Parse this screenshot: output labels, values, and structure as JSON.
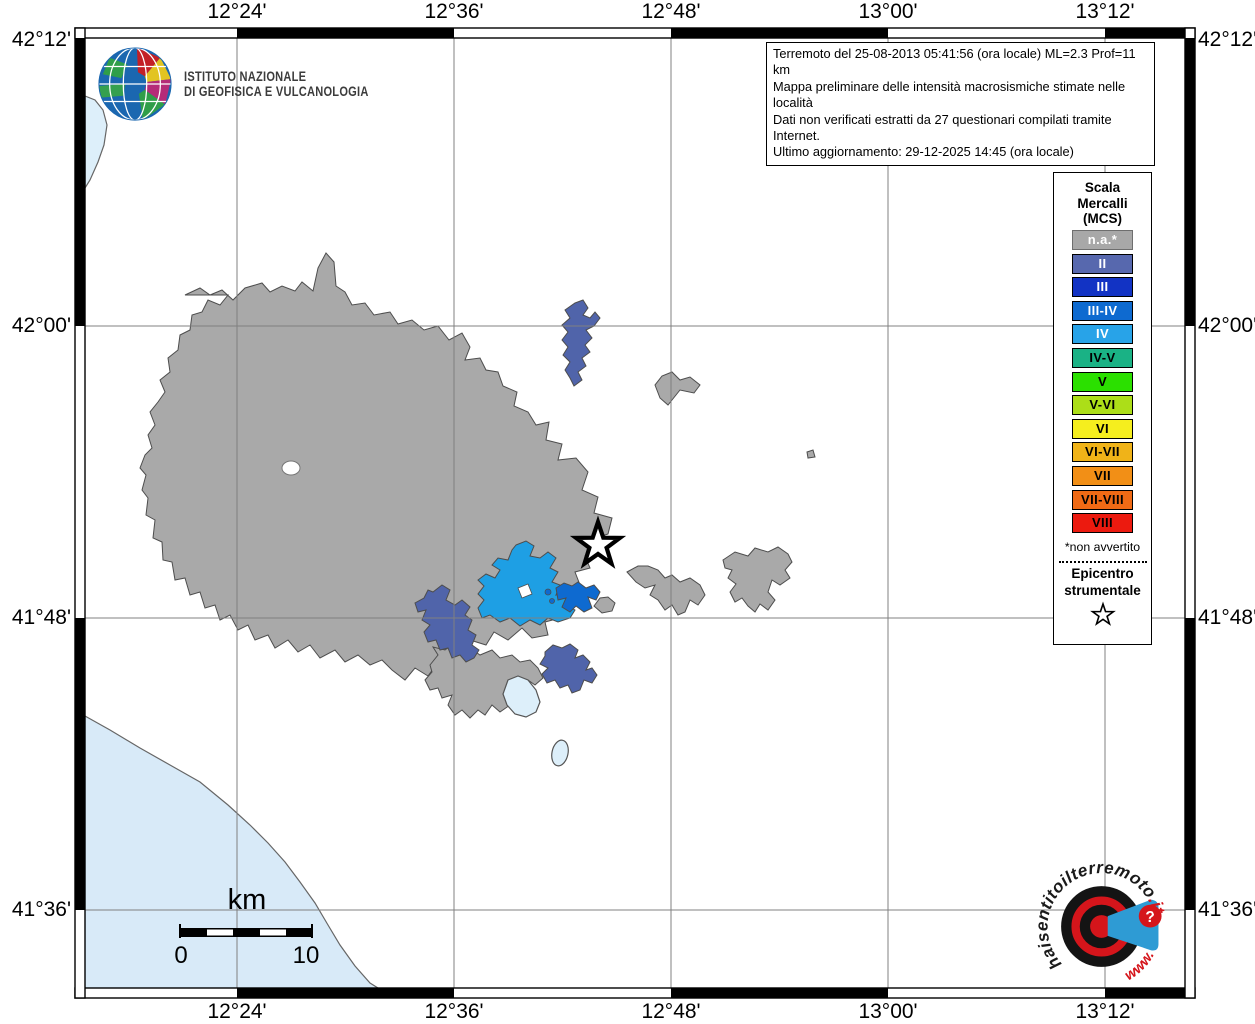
{
  "colors": {
    "muni_gray": "#a9a9a9",
    "muni_outline": "#4d4d4d",
    "sea": "#d8eaf8",
    "lake": "#ddeffa",
    "grid": "#808080",
    "intensity_ii": "#5064aa",
    "intensity_iii_iv": "#0e6ad0",
    "intensity_iv": "#1e9fe4",
    "frame": "#000000",
    "wm_red": "#d5151b",
    "wm_blue": "#2e9bd4"
  },
  "title_box": {
    "line1": "Terremoto del 25-08-2013 05:41:56 (ora locale) ML=2.3 Prof=11 km",
    "line2": "Mappa preliminare delle intensità macrosismiche stimate nelle località",
    "line3": "Dati non verificati estratti da 27 questionari compilati tramite Internet.",
    "line4": "Ultimo aggiornamento: 29-12-2025 14:45 (ora locale)"
  },
  "ingv": {
    "name_line1": "ISTITUTO NAZIONALE",
    "name_line2": "DI GEOFISICA E VULCANOLOGIA"
  },
  "axes": {
    "top": [
      "12°24'",
      "12°36'",
      "12°48'",
      "13°00'",
      "13°12'"
    ],
    "bottom": [
      "12°24'",
      "12°36'",
      "12°48'",
      "13°00'",
      "13°12'"
    ],
    "left": [
      "42°12'",
      "42°00'",
      "41°48'",
      "41°36'"
    ],
    "right": [
      "42°12'",
      "42°00'",
      "41°48'",
      "41°36'"
    ]
  },
  "legend": {
    "title_line1": "Scala",
    "title_line2": "Mercalli",
    "title_line3": "(MCS)",
    "items": [
      {
        "label": "n.a.*",
        "color": "#a8a8a8",
        "text": "#ffffff"
      },
      {
        "label": "II",
        "color": "#5768ae",
        "text": "#ffffff"
      },
      {
        "label": "III",
        "color": "#1233c4",
        "text": "#ffffff"
      },
      {
        "label": "III-IV",
        "color": "#0e6ad0",
        "text": "#ffffff"
      },
      {
        "label": "IV",
        "color": "#28a3e8",
        "text": "#ffffff"
      },
      {
        "label": "IV-V",
        "color": "#1ab285",
        "text": "#000000"
      },
      {
        "label": "V",
        "color": "#2be000",
        "text": "#000000"
      },
      {
        "label": "V-VI",
        "color": "#acde18",
        "text": "#000000"
      },
      {
        "label": "VI",
        "color": "#f5ee1e",
        "text": "#000000"
      },
      {
        "label": "VI-VII",
        "color": "#f0b318",
        "text": "#000000"
      },
      {
        "label": "VII",
        "color": "#f28f16",
        "text": "#000000"
      },
      {
        "label": "VII-VIII",
        "color": "#f06a15",
        "text": "#000000"
      },
      {
        "label": "VIII",
        "color": "#ec1a0f",
        "text": "#000000"
      }
    ],
    "footnote": "*non avvertito",
    "epicenter_line1": "Epicentro",
    "epicenter_line2": "strumentale"
  },
  "scalebar": {
    "unit": "km",
    "start": "0",
    "end": "10"
  },
  "watermark": {
    "ring_main": "haisentitoilterremoto",
    "ring_suffix": ".it",
    "www": "www.",
    "question": "?"
  }
}
